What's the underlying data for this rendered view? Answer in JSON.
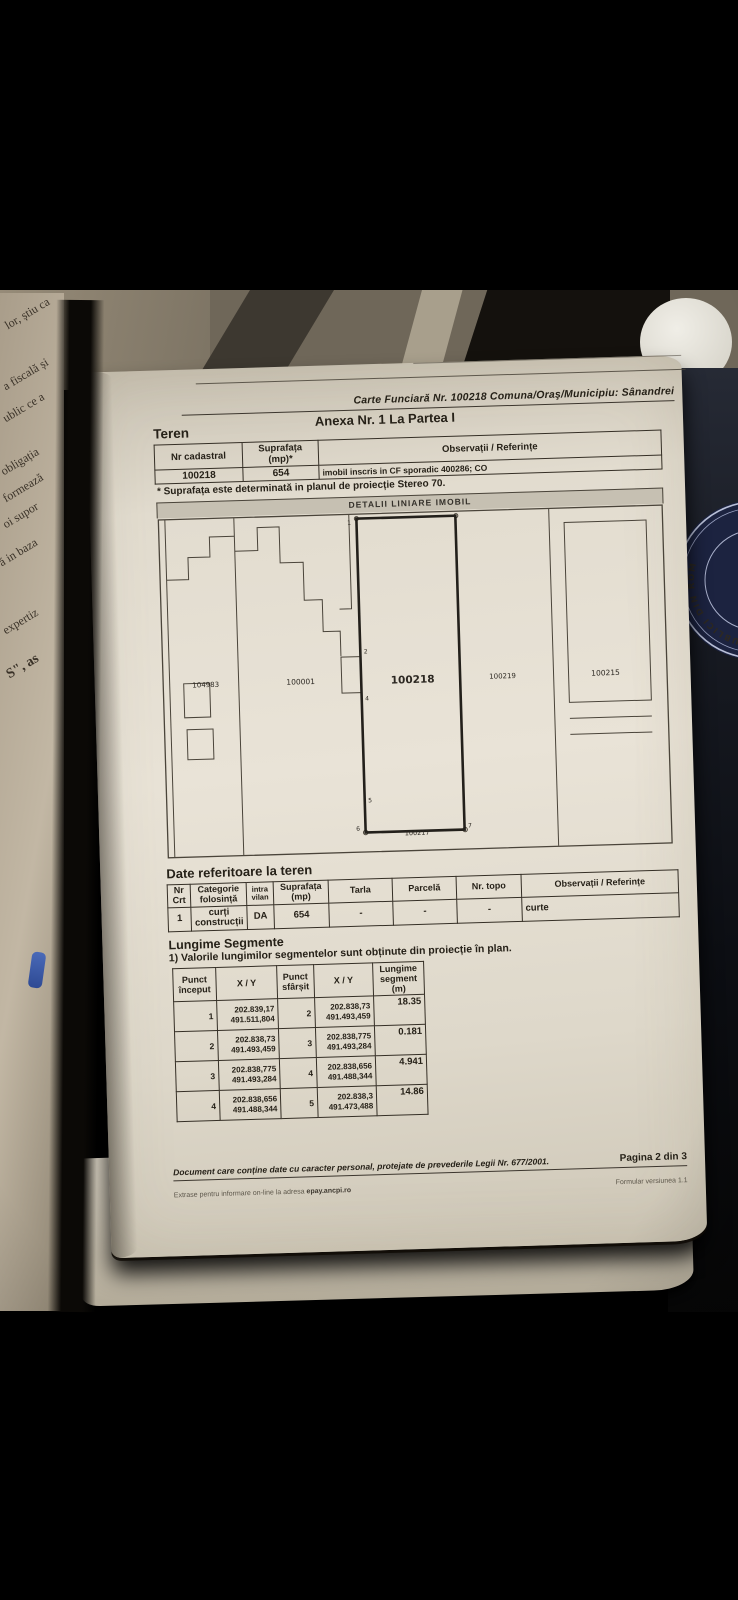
{
  "photo": {
    "left_page_fragments": [
      "lor, știu ca",
      "a fiscală și",
      "ublic ce a",
      "obligația",
      "formează",
      "oi supor",
      "ă in baza",
      "expertiz",
      "S\", as"
    ],
    "seal_text": "PUBLICI DIN ROM",
    "colors": {
      "paper": "#e9e3d7",
      "seal_navy": "#1c2340",
      "background": "#000000"
    }
  },
  "document": {
    "header": {
      "carte_line": "Carte Funciară Nr. 100218 Comuna/Oraş/Municipiu: Sânandrei",
      "anexa_line": "Anexa Nr. 1 La Partea I",
      "teren_title": "Teren"
    },
    "teren_table": {
      "col1_header": "Nr cadastral",
      "col2_header": "Suprafața (mp)*",
      "obs_header": "Observații / Referințe",
      "nr_cadastral": "100218",
      "suprafata": "654",
      "obs_value": "imobil inscris in CF sporadic 400286; CO",
      "footnote": "* Suprafața este determinată in planul de proiecție Stereo 70."
    },
    "plan": {
      "title": "DETALII LINIARE IMOBIL",
      "parcels": [
        "104983",
        "100001",
        "100218",
        "100219",
        "100215"
      ],
      "bottom_label": "100217",
      "points": [
        "1",
        "2",
        "4",
        "5",
        "6",
        "7"
      ]
    },
    "date_teren": {
      "title": "Date referitoare la teren",
      "headers": [
        "Nr Crt",
        "Categorie folosință",
        "intra vilan",
        "Suprafața (mp)",
        "Tarla",
        "Parcelă",
        "Nr. topo",
        "Observații / Referințe"
      ],
      "row": [
        "1",
        "curți construcții",
        "DA",
        "654",
        "-",
        "-",
        "-",
        "curte"
      ]
    },
    "segments": {
      "title": "Lungime Segmente",
      "note": "1) Valorile lungimilor segmentelor sunt obținute din proiecție în plan.",
      "headers": [
        "Punct început",
        "X / Y",
        "Punct sfârșit",
        "X / Y",
        "Lungime segment (m)"
      ],
      "rows": [
        {
          "a": "1",
          "ax": "202.839,17",
          "ay": "491.511,804",
          "b": "2",
          "bx": "202.838,73",
          "by": "491.493,459",
          "len": "18.35"
        },
        {
          "a": "2",
          "ax": "202.838,73",
          "ay": "491.493,459",
          "b": "3",
          "bx": "202.838,775",
          "by": "491.493,284",
          "len": "0.181"
        },
        {
          "a": "3",
          "ax": "202.838,775",
          "ay": "491.493,284",
          "b": "4",
          "bx": "202.838,656",
          "by": "491.488,344",
          "len": "4.941"
        },
        {
          "a": "4",
          "ax": "202.838,656",
          "ay": "491.488,344",
          "b": "5",
          "bx": "202.838,3",
          "by": "491.473,488",
          "len": "14.86"
        }
      ]
    },
    "footer": {
      "privacy": "Document care conține date cu caracter personal, protejate de prevederile Legii Nr. 677/2001.",
      "page": "Pagina 2 din 3",
      "extras_prefix": "Extrase pentru informare on-line la adresa ",
      "extras_link": "epay.ancpi.ro",
      "form_version": "Formular versiunea 1.1"
    }
  }
}
